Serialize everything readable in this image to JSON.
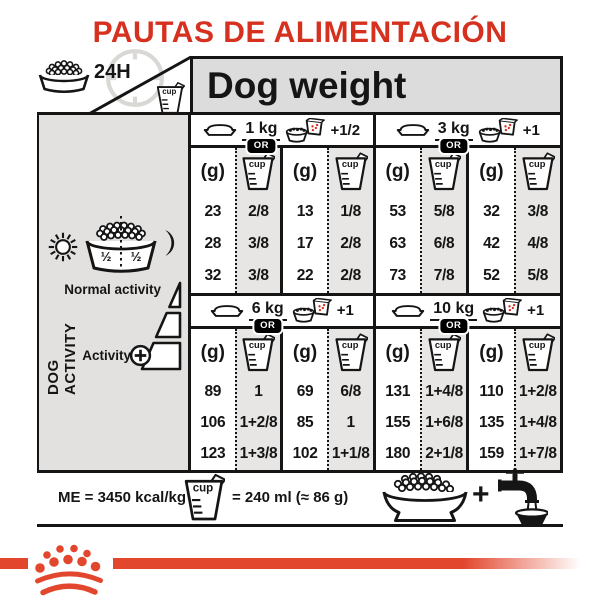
{
  "title": "PAUTAS DE ALIMENTACIÓN",
  "header": {
    "daily_ration_label": "24H",
    "table_title": "Dog weight"
  },
  "columns": {
    "grams_label": "(g)",
    "cup_word": "cup"
  },
  "sections": [
    {
      "weight": "1 kg",
      "or_label": "OR",
      "cup_equiv": "+1/2",
      "rows": [
        [
          "23",
          "2/8",
          "13",
          "1/8"
        ],
        [
          "28",
          "3/8",
          "17",
          "2/8"
        ],
        [
          "32",
          "3/8",
          "22",
          "2/8"
        ]
      ]
    },
    {
      "weight": "3 kg",
      "or_label": "OR",
      "cup_equiv": "+1",
      "rows": [
        [
          "53",
          "5/8",
          "32",
          "3/8"
        ],
        [
          "63",
          "6/8",
          "42",
          "4/8"
        ],
        [
          "73",
          "7/8",
          "52",
          "5/8"
        ]
      ]
    },
    {
      "weight": "6 kg",
      "or_label": "OR",
      "cup_equiv": "+1",
      "rows": [
        [
          "89",
          "1",
          "69",
          "6/8"
        ],
        [
          "106",
          "1+2/8",
          "85",
          "1"
        ],
        [
          "123",
          "1+3/8",
          "102",
          "1+1/8"
        ]
      ]
    },
    {
      "weight": "10 kg",
      "or_label": "OR",
      "cup_equiv": "+1",
      "rows": [
        [
          "131",
          "1+4/8",
          "110",
          "1+2/8"
        ],
        [
          "155",
          "1+6/8",
          "135",
          "1+4/8"
        ],
        [
          "180",
          "2+1/8",
          "159",
          "1+7/8"
        ]
      ]
    }
  ],
  "sidebar": {
    "vertical_label": "DOG ACTIVITY",
    "meal_split_left": "½",
    "meal_split_right": "½",
    "normal_activity_label": "Normal activity",
    "activity_label": "Activity"
  },
  "footer": {
    "energy_label": "ME = 3450 kcal/kg",
    "cup_equivalence": "= 240 ml (≈ 86 g)",
    "plus_sign": "+"
  },
  "icons": {
    "kibble-bowl-icon": "dog bowl filled with kibble",
    "clock-24h-icon": "faint clock dial behind 24H label",
    "measuring-cup-icon": "measuring cup labelled cup",
    "dog-bowl-icon": "empty dog bowl silhouette",
    "food-sachet-bowl-icon": "bowl of kibble with sachet pouring red pieces",
    "sun-icon": "sun with rays (morning meal)",
    "moon-icon": "crescent moon (evening meal)",
    "split-meal-bowl-icon": "bowl split in two halves by dotted line",
    "activity-wedge-icon": "three-step increasing wedge",
    "plus-circle-icon": "circled plus",
    "water-tap-icon": "tap pouring water into a bowl",
    "royal-canin-crown-icon": "crown made of dots above two arcs"
  },
  "colors": {
    "accent_red": "#d6301f",
    "brand_red": "#e2472e",
    "line_black": "#151515",
    "sidebar_gray": "#e2e1df",
    "cup_column_gray": "#e7e6e4",
    "band_gray": "#dcdcdc"
  }
}
